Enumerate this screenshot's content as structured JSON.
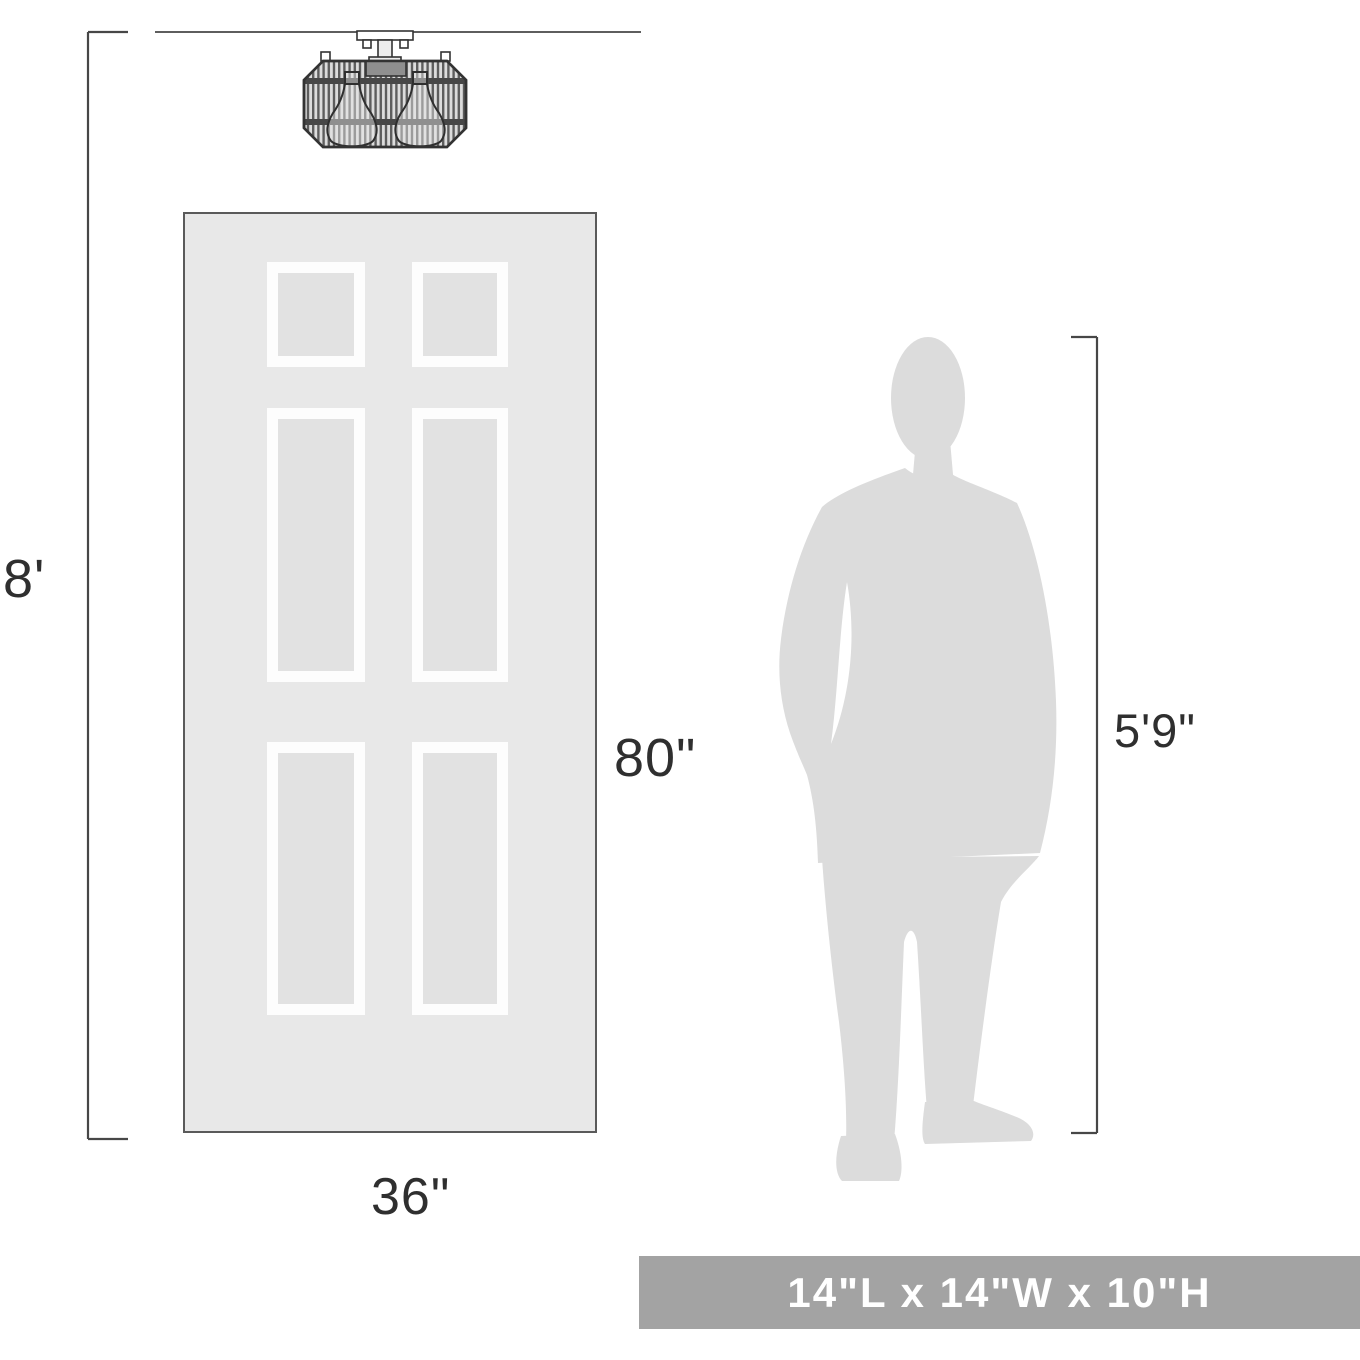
{
  "figure": {
    "labels": {
      "ceiling_height": "8'",
      "door_height": "80\"",
      "door_width": "36\"",
      "person_height": "5'9\""
    },
    "banner": {
      "dimensions_text": "14\"L x 14\"W x 10\"H"
    },
    "icons": {
      "fixture": "ceiling-light-fixture-icon",
      "door": "six-panel-door-icon",
      "person": "standing-man-silhouette-icon"
    }
  },
  "colors": {
    "dimension_line": "#474747",
    "label_text": "#2f2f2f",
    "door_fill": "#e8e8e8",
    "door_border": "#5a5a5a",
    "panel_frame": "#fdfdfd",
    "panel_inset": "#e2e2e2",
    "silhouette": "#dcdcdc",
    "banner_bg": "#a3a3a3",
    "banner_text": "#ffffff",
    "fixture_stroke": "#333333",
    "fixture_rod_dark": "#5d5d5d",
    "fixture_rod_light": "#dcdcdc",
    "background": "#ffffff"
  }
}
